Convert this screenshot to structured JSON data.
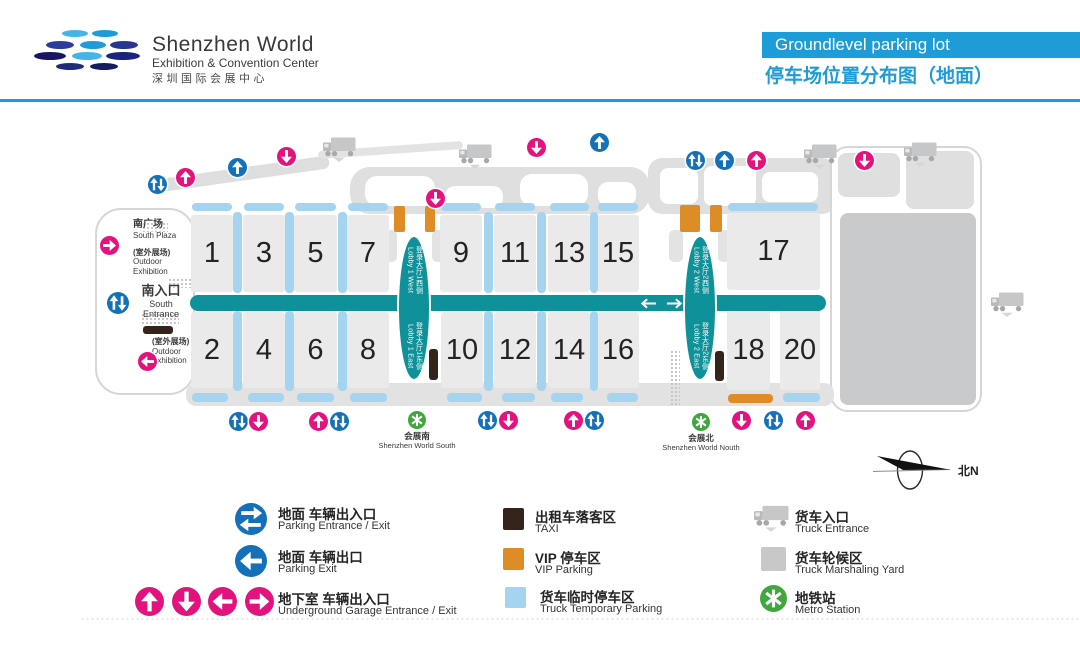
{
  "header": {
    "brand_title": "Shenzhen World",
    "brand_subtitle": "Exhibition & Convention Center",
    "brand_cn": "深圳国际会展中心",
    "banner": "Groundlevel parking lot",
    "title_cn": "停车场位置分布图（地面）"
  },
  "map": {
    "halls_top": [
      "1",
      "3",
      "5",
      "7",
      "9",
      "11",
      "13",
      "15",
      "17"
    ],
    "halls_bottom": [
      "2",
      "4",
      "6",
      "8",
      "10",
      "12",
      "14",
      "16",
      "18",
      "20"
    ],
    "lobbies": [
      {
        "cn": "登录大厅1西侧",
        "en": "Lobby 1 West"
      },
      {
        "cn": "登录大厅1东侧",
        "en": "Lobby 1 East"
      },
      {
        "cn": "登录大厅2西侧",
        "en": "Lobby 2 West"
      },
      {
        "cn": "登录大厅2东侧",
        "en": "Lobby 2 East"
      }
    ],
    "labels": {
      "south_plaza_cn": "南广场",
      "south_plaza_en": "South Plaza",
      "outdoor_cn": "(室外展场)",
      "outdoor_en_1": "Outdoor",
      "outdoor_en_2": "Exhibition",
      "south_entrance_cn": "南入口",
      "south_entrance_en": "South Entrance",
      "metro_south_cn": "会展南",
      "metro_south_en": "Shenzhen World South",
      "metro_north_cn": "会展北",
      "metro_north_en": "Shenzhen World Nouth",
      "compass": "北N"
    }
  },
  "legend": {
    "left": [
      {
        "cn": "地面 车辆出入口",
        "en": "Parking Entrance / Exit"
      },
      {
        "cn": "地面 车辆出口",
        "en": "Parking Exit"
      },
      {
        "cn": "地下室 车辆出入口",
        "en": "Underground Garage Entrance / Exit"
      }
    ],
    "middle": [
      {
        "cn": "出租车落客区",
        "en": "TAXI"
      },
      {
        "cn": "VIP 停车区",
        "en": "VIP Parking"
      },
      {
        "cn": "货车临时停车区",
        "en": "Truck Temporary Parking"
      }
    ],
    "right": [
      {
        "cn": "货车入口",
        "en": "Truck Entrance"
      },
      {
        "cn": "货车轮候区",
        "en": "Truck Marshaling Yard"
      },
      {
        "cn": "地铁站",
        "en": "Metro Station"
      }
    ]
  },
  "colors": {
    "banner_blue": "#1E9CD7",
    "road_teal": "#0F9199",
    "parking_blue": "#1470B8",
    "underground_pink": "#E3137E",
    "truck_parking_blue": "#A5D4F0",
    "vip_orange": "#DE8C26",
    "taxi_brown": "#35241B",
    "metro_green": "#3FA83C",
    "marshaling_gray": "#C7C8CA"
  }
}
